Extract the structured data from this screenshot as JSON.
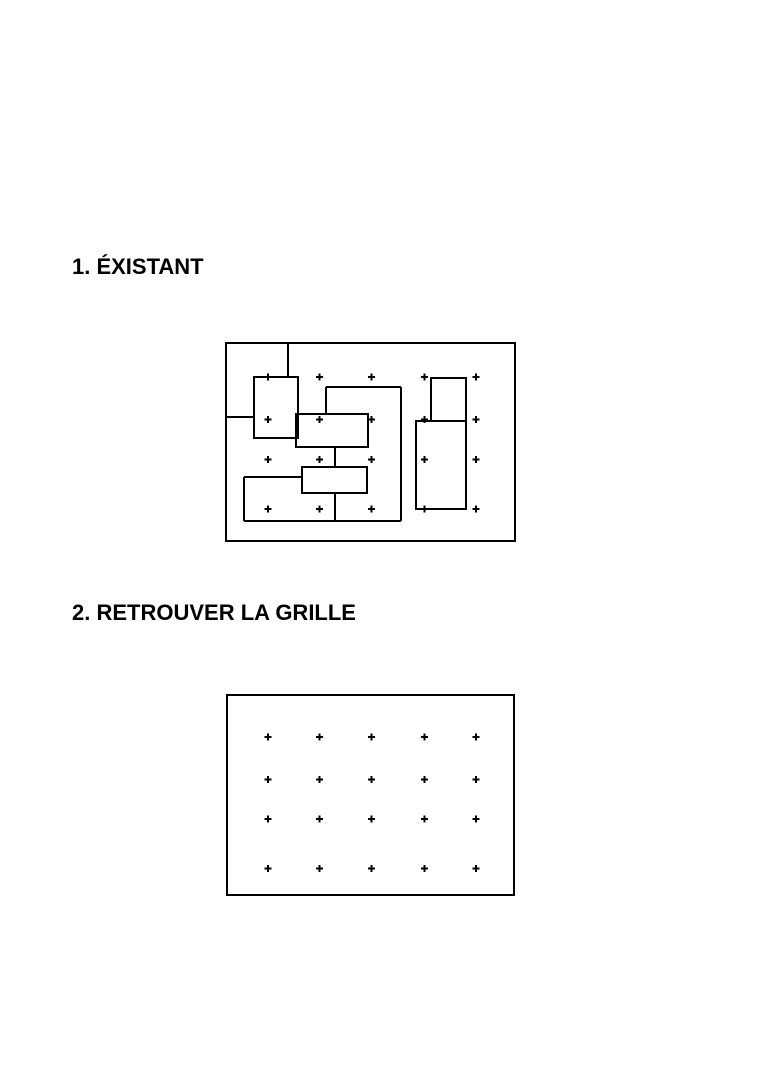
{
  "page": {
    "width": 768,
    "height": 1086,
    "background": "#ffffff",
    "ink": "#000000"
  },
  "sections": [
    {
      "id": "existant",
      "heading": "1. ÉXISTANT"
    },
    {
      "id": "retrouver-la-grille",
      "heading": "2. RETROUVER LA GRILLE"
    }
  ],
  "style": {
    "line_color": "#000000",
    "line_width": 2,
    "cross_size": 7,
    "cross_stroke": 2
  },
  "figures": [
    {
      "name": "existant-plan",
      "frame": {
        "x": 226,
        "y": 343,
        "w": 289,
        "h": 198
      },
      "grid": {
        "cols": [
          268,
          319.5,
          371.5,
          424.5,
          476
        ],
        "rows": [
          377,
          419.5,
          459.5,
          509
        ]
      },
      "rects": [
        {
          "x": 254,
          "y": 377,
          "w": 44,
          "h": 61
        },
        {
          "x": 296,
          "y": 414,
          "w": 72,
          "h": 33
        },
        {
          "x": 302,
          "y": 467,
          "w": 65,
          "h": 26
        },
        {
          "x": 431,
          "y": 378,
          "w": 35,
          "h": 43
        },
        {
          "x": 416,
          "y": 421,
          "w": 50,
          "h": 88
        }
      ],
      "lines": [
        {
          "x1": 288,
          "y1": 344,
          "x2": 288,
          "y2": 377
        },
        {
          "x1": 226,
          "y1": 417,
          "x2": 254,
          "y2": 417
        },
        {
          "x1": 326,
          "y1": 387,
          "x2": 326,
          "y2": 414
        },
        {
          "x1": 326,
          "y1": 387,
          "x2": 401,
          "y2": 387
        },
        {
          "x1": 401,
          "y1": 387,
          "x2": 401,
          "y2": 521
        },
        {
          "x1": 244,
          "y1": 521,
          "x2": 401,
          "y2": 521
        },
        {
          "x1": 244,
          "y1": 477,
          "x2": 244,
          "y2": 521
        },
        {
          "x1": 244,
          "y1": 477,
          "x2": 302,
          "y2": 477
        },
        {
          "x1": 335,
          "y1": 447,
          "x2": 335,
          "y2": 467
        },
        {
          "x1": 335,
          "y1": 493,
          "x2": 335,
          "y2": 521
        }
      ]
    },
    {
      "name": "empty-grid",
      "frame": {
        "x": 227,
        "y": 695,
        "w": 287,
        "h": 200
      },
      "grid": {
        "cols": [
          268,
          319.5,
          371.5,
          424.5,
          476
        ],
        "rows": [
          737,
          779.5,
          819,
          868.5
        ]
      },
      "rects": [],
      "lines": []
    }
  ]
}
